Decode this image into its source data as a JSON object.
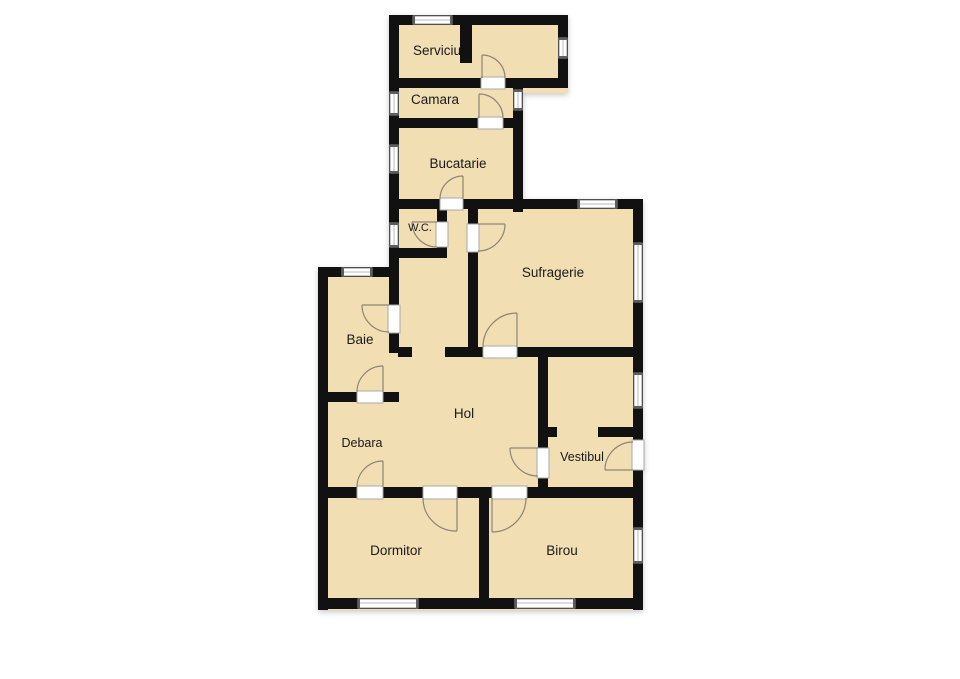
{
  "floorplan": {
    "rooms": [
      {
        "id": "serviciu",
        "label": "Serviciu"
      },
      {
        "id": "camara",
        "label": "Camara"
      },
      {
        "id": "bucatarie",
        "label": "Bucatarie"
      },
      {
        "id": "wc",
        "label": "W.C."
      },
      {
        "id": "sufragerie",
        "label": "Sufragerie"
      },
      {
        "id": "baie",
        "label": "Baie"
      },
      {
        "id": "hol",
        "label": "Hol"
      },
      {
        "id": "debara",
        "label": "Debara"
      },
      {
        "id": "vestibul",
        "label": "Vestibul"
      },
      {
        "id": "dormitor",
        "label": "Dormitor"
      },
      {
        "id": "birou",
        "label": "Birou"
      }
    ],
    "colors": {
      "background": "#ffffff",
      "floor": "#f2deb3",
      "wall": "#111111",
      "window_frame": "#8f8f8f",
      "door_symbol": "#8c8474",
      "label_text": "#1a1a1a"
    }
  }
}
